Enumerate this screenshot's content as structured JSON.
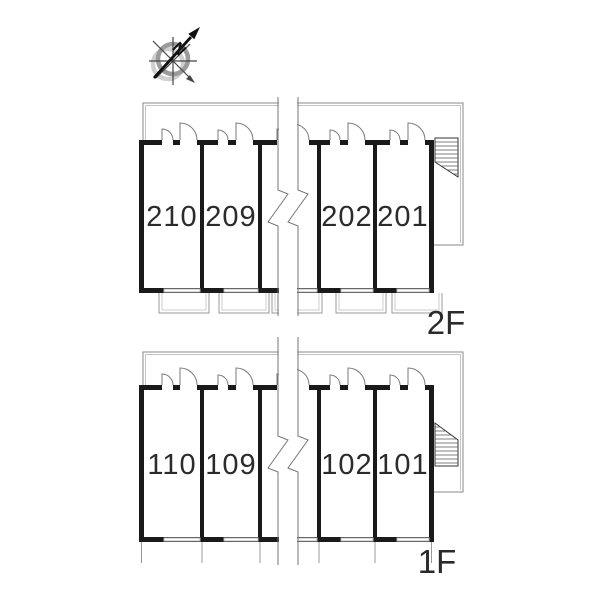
{
  "compass": {
    "north_label": "N"
  },
  "floors": [
    {
      "label": "2F",
      "rooms": [
        "210",
        "209",
        "202",
        "201"
      ]
    },
    {
      "label": "1F",
      "rooms": [
        "110",
        "109",
        "102",
        "101"
      ]
    }
  ],
  "colors": {
    "wall": "#1a1a1a",
    "thin_line": "#8a8a8a",
    "light_line": "#c4c4c4",
    "text": "#2b2b2b"
  }
}
